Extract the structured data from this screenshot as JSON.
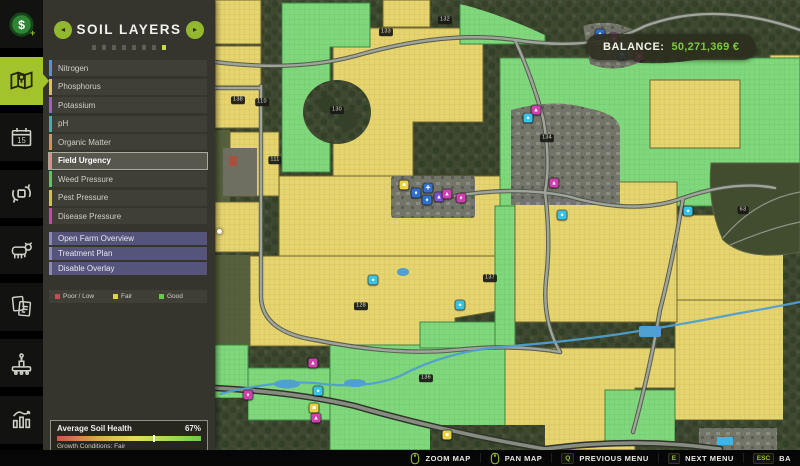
{
  "header": {
    "title": "SOIL LAYERS",
    "dots": {
      "count": 8,
      "active_index": 7
    }
  },
  "sidebar": {
    "items": [
      {
        "id": "finances",
        "active": false
      },
      {
        "id": "map",
        "active": true
      },
      {
        "id": "calendar",
        "active": false
      },
      {
        "id": "production",
        "active": false
      },
      {
        "id": "animals",
        "active": false
      },
      {
        "id": "contracts",
        "active": false
      },
      {
        "id": "production-chains",
        "active": false
      },
      {
        "id": "statistics",
        "active": false
      }
    ]
  },
  "panel": {
    "layers": [
      {
        "label": "Nitrogen",
        "color": "#5b8fd9",
        "selected": false
      },
      {
        "label": "Phosphorus",
        "color": "#d9c25b",
        "selected": false
      },
      {
        "label": "Potassium",
        "color": "#9a5fd0",
        "selected": false
      },
      {
        "label": "pH",
        "color": "#3fb3a9",
        "selected": false
      },
      {
        "label": "Organic Matter",
        "color": "#d9905b",
        "selected": false
      },
      {
        "label": "Field Urgency",
        "color": "#e58b8b",
        "selected": true
      },
      {
        "label": "Weed Pressure",
        "color": "#55c96a",
        "selected": false
      },
      {
        "label": "Pest Pressure",
        "color": "#d0c542",
        "selected": false
      },
      {
        "label": "Disease Pressure",
        "color": "#d0459f",
        "selected": false
      }
    ],
    "actions": [
      {
        "label": "Open Farm Overview"
      },
      {
        "label": "Treatment Plan"
      },
      {
        "label": "Disable Overlay"
      }
    ],
    "legend": [
      {
        "label": "Poor / Low",
        "color": "#c94a54"
      },
      {
        "label": "Fair",
        "color": "#ddd34f"
      },
      {
        "label": "Good",
        "color": "#63cc43"
      }
    ],
    "soil_health": {
      "title": "Average Soil Health",
      "value": "67%",
      "percent": 67,
      "conditions": "Growth Conditions: Fair"
    }
  },
  "balance": {
    "label": "BALANCE:",
    "value": "50,271,369 €",
    "value_color": "#7ec843"
  },
  "bottom_bar": {
    "items": [
      {
        "icon": "mouse-wheel-icon",
        "label": "ZOOM MAP"
      },
      {
        "icon": "mouse-icon",
        "label": "PAN MAP"
      },
      {
        "key": "Q",
        "label": "PREVIOUS MENU"
      },
      {
        "key": "E",
        "label": "NEXT MENU"
      },
      {
        "key": "ESC",
        "label": "BA"
      }
    ]
  },
  "map": {
    "field_labels": [
      {
        "x": 23,
        "y": 100,
        "t": "138"
      },
      {
        "x": 47,
        "y": 102,
        "t": "110"
      },
      {
        "x": 60,
        "y": 160,
        "t": "111"
      },
      {
        "x": 122,
        "y": 110,
        "t": "130"
      },
      {
        "x": 171,
        "y": 32,
        "t": "133"
      },
      {
        "x": 230,
        "y": 20,
        "t": "132"
      },
      {
        "x": 332,
        "y": 138,
        "t": "134"
      },
      {
        "x": 528,
        "y": 210,
        "t": "63"
      },
      {
        "x": 146,
        "y": 306,
        "t": "128"
      },
      {
        "x": 275,
        "y": 278,
        "t": "137"
      },
      {
        "x": 211,
        "y": 378,
        "t": "136"
      }
    ],
    "pois": [
      {
        "x": 385,
        "y": 34,
        "c": "#2f6fd0",
        "g": "♦"
      },
      {
        "x": 399,
        "y": 38,
        "c": "#cf3fae",
        "g": "▲"
      },
      {
        "x": 407,
        "y": 55,
        "c": "#2f6fd0",
        "g": "✚"
      },
      {
        "x": 424,
        "y": 56,
        "c": "#cf3fae",
        "g": "▲"
      },
      {
        "x": 321,
        "y": 110,
        "c": "#cf3fae",
        "g": "▲"
      },
      {
        "x": 313,
        "y": 118,
        "c": "#35c4e8",
        "g": "●"
      },
      {
        "x": 339,
        "y": 183,
        "c": "#cf3fae",
        "g": "▲"
      },
      {
        "x": 347,
        "y": 215,
        "c": "#35c4e8",
        "g": "●"
      },
      {
        "x": 473,
        "y": 211,
        "c": "#35c4e8",
        "g": "●"
      },
      {
        "x": 189,
        "y": 185,
        "c": "#e8d23f",
        "g": "■"
      },
      {
        "x": 201,
        "y": 193,
        "c": "#2f6fd0",
        "g": "♦"
      },
      {
        "x": 213,
        "y": 188,
        "c": "#2f6fd0",
        "g": "✚"
      },
      {
        "x": 212,
        "y": 200,
        "c": "#2f6fd0",
        "g": "♦"
      },
      {
        "x": 224,
        "y": 197,
        "c": "#7a4fd0",
        "g": "▲"
      },
      {
        "x": 232,
        "y": 194,
        "c": "#cf3fae",
        "g": "▲"
      },
      {
        "x": 246,
        "y": 198,
        "c": "#cf3fae",
        "g": "♦"
      },
      {
        "x": 98,
        "y": 363,
        "c": "#cf3fae",
        "g": "▲"
      },
      {
        "x": 103,
        "y": 391,
        "c": "#35c4e8",
        "g": "●"
      },
      {
        "x": 99,
        "y": 408,
        "c": "#e8d23f",
        "g": "■"
      },
      {
        "x": 101,
        "y": 418,
        "c": "#cf3fae",
        "g": "▲"
      },
      {
        "x": 33,
        "y": 395,
        "c": "#cf3fae",
        "g": "♦"
      },
      {
        "x": 232,
        "y": 435,
        "c": "#e8d23f",
        "g": "■"
      },
      {
        "x": 158,
        "y": 280,
        "c": "#35c4e8",
        "g": "●"
      },
      {
        "x": 245,
        "y": 305,
        "c": "#35c4e8",
        "g": "●"
      }
    ]
  }
}
